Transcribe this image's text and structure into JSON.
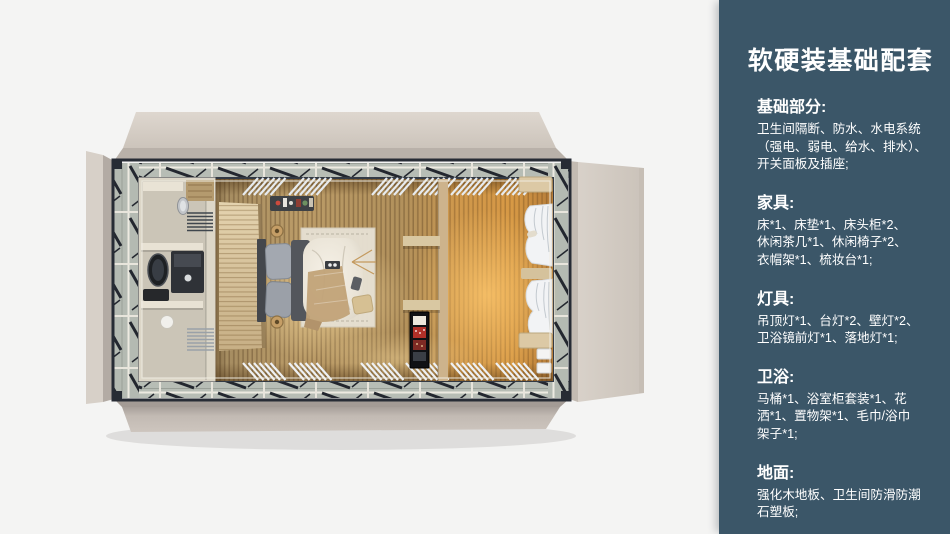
{
  "panel": {
    "title": "软硬装基础配套",
    "background_color": "#3b5668",
    "text_color": "#ffffff",
    "sections": [
      {
        "heading": "基础部分:",
        "lines": [
          "卫生间隔断、防水、水电系统",
          "（强电、弱电、给水、排水）、",
          "开关面板及插座;"
        ]
      },
      {
        "heading": "家具:",
        "lines": [
          "床*1、床垫*1、床头柜*2、",
          "休闲茶几*1、休闲椅子*2、",
          "衣帽架*1、梳妆台*1;"
        ]
      },
      {
        "heading": "灯具:",
        "lines": [
          "吊顶灯*1、台灯*2、壁灯*2、",
          "卫浴镜前灯*1、落地灯*1;"
        ]
      },
      {
        "heading": "卫浴:",
        "lines": [
          "马桶*1、浴室柜套装*1、花",
          "洒*1、置物架*1、毛巾/浴巾",
          "架子*1;"
        ]
      },
      {
        "heading": "地面:",
        "lines": [
          "强化木地板、卫生间防滑防潮",
          "石塑板;"
        ]
      }
    ]
  },
  "illustration": {
    "kind": "top-down 3d render of prefab bedroom module with fold-out walls",
    "zones": [
      "bathroom",
      "wardrobe-panel",
      "bed-with-rug",
      "partition-shelves",
      "minibar-cabinet",
      "lounge-with-curtains"
    ]
  }
}
